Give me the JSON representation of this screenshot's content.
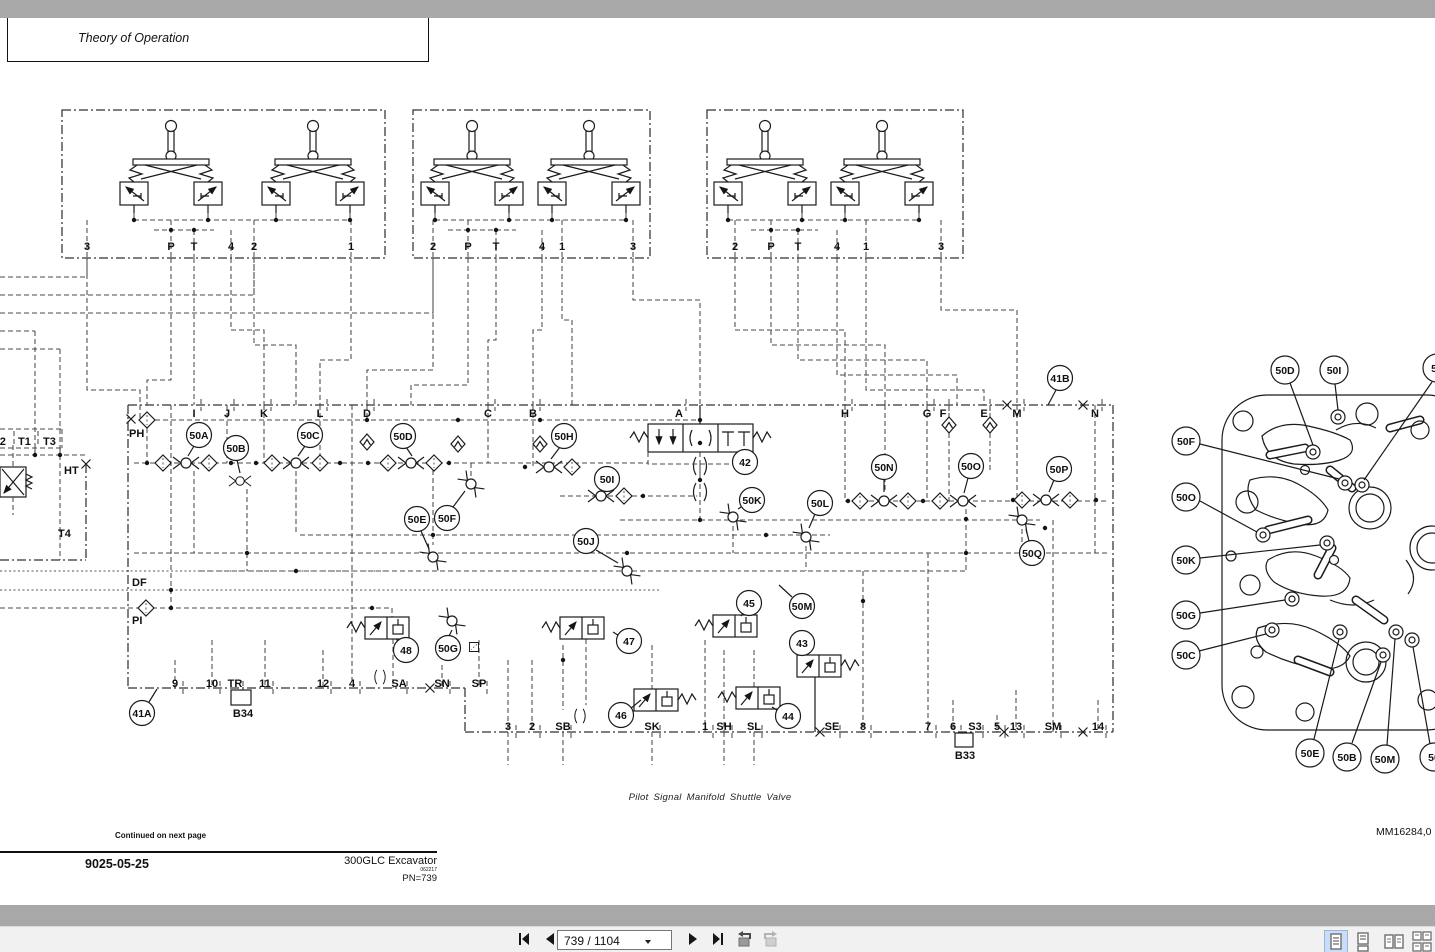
{
  "header": {
    "title": "Theory of Operation"
  },
  "caption": {
    "text": "Pilot Signal Manifold Shuttle Valve"
  },
  "footer": {
    "continued": "Continued on next page",
    "section": "9025-05-25",
    "model": "300GLC Excavator",
    "model_date": "062217",
    "pn": "PN=739",
    "doc_id": "MM16284,0"
  },
  "toolbar": {
    "page_field": "739 / 1104"
  },
  "schematic": {
    "group1_ports": [
      "3",
      "P",
      "T",
      "4",
      "2",
      "1"
    ],
    "group2_ports": [
      "2",
      "P",
      "T",
      "4",
      "1",
      "3"
    ],
    "group3_ports": [
      "2",
      "P",
      "T",
      "4",
      "1",
      "3"
    ],
    "top_ports": [
      "I",
      "J",
      "K",
      "L",
      "D",
      "C",
      "B",
      "A",
      "H",
      "G",
      "F",
      "E",
      "M",
      "N"
    ],
    "left_labels": {
      "t2": "T2",
      "t1": "T1",
      "t3": "T3",
      "ht": "HT",
      "t4": "T4",
      "ph": "PH",
      "df": "DF",
      "pi": "PI"
    },
    "bottom_ports_upper": [
      "9",
      "10",
      "TR",
      "11",
      "12",
      "4",
      "SA",
      "SN",
      "SP"
    ],
    "bottom_ports_lower": [
      "3",
      "2",
      "SB",
      "SK",
      "1",
      "SH",
      "SL",
      "SE",
      "8",
      "7",
      "6",
      "S3",
      "5",
      "13",
      "SM",
      "14"
    ],
    "connectors": {
      "b34": "B34",
      "b33": "B33"
    },
    "callouts": {
      "c41a": "41A",
      "c41b": "41B",
      "c42": "42",
      "c43": "43",
      "c44": "44",
      "c45": "45",
      "c46": "46",
      "c47": "47",
      "c48": "48",
      "c50a": "50A",
      "c50b": "50B",
      "c50c": "50C",
      "c50d": "50D",
      "c50e": "50E",
      "c50f": "50F",
      "c50g": "50G",
      "c50h": "50H",
      "c50i": "50I",
      "c50j": "50J",
      "c50k": "50K",
      "c50l": "50L",
      "c50m": "50M",
      "c50n": "50N",
      "c50o": "50O",
      "c50p": "50P",
      "c50q": "50Q"
    }
  },
  "plate": {
    "callouts": {
      "d": "50D",
      "i": "50I",
      "f": "50F",
      "o": "50O",
      "k": "50K",
      "g": "50G",
      "c": "50C",
      "e": "50E",
      "b": "50B",
      "m": "50M",
      "clip_top": "50",
      "clip_bot": "50"
    }
  }
}
